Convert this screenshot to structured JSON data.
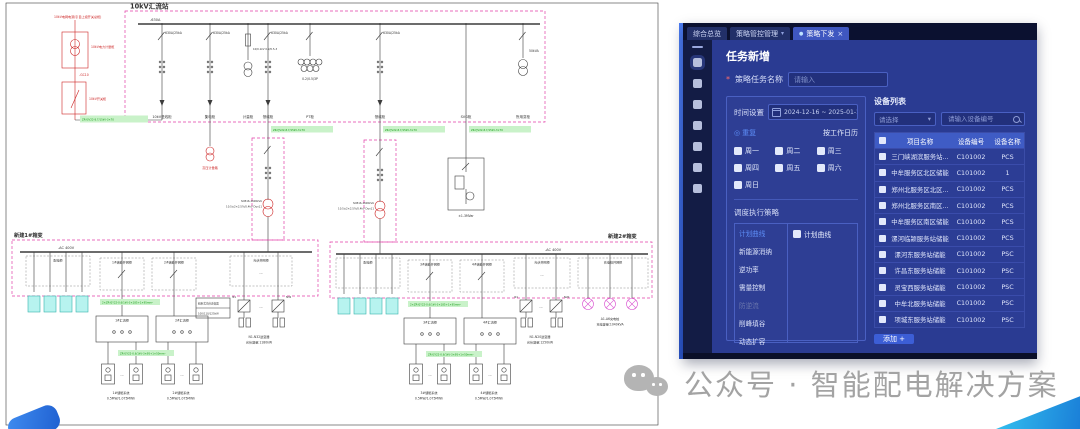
{
  "icons": {
    "caret": "▾",
    "close": "×",
    "dot": "●",
    "radio": "◎",
    "ellipsis": "···"
  },
  "diagram": {
    "station_title": "10kV汇流站",
    "incoming_source": "10kV电网电源(引自上级开关总柜)",
    "incoming_metering": "10kV电力计量柜",
    "incoming_node": "-GC10",
    "incoming_switch": "10kV开关柜",
    "hv_metering_box": "高压计量箱",
    "bus_label": "-630A",
    "bays": [
      {
        "rating": "630A/25kA",
        "name": "10kV进线柜"
      },
      {
        "rating": "630A/25kA",
        "name": "集电柜"
      },
      {
        "rating": "10/0.1kV 0.2/0.5-3",
        "name": "计量柜"
      },
      {
        "rating": "630A/25kA",
        "name": "馈线柜"
      },
      {
        "rating": "0.2/0.5/3P",
        "name": "PT柜"
      },
      {
        "rating": "630A/25kA",
        "name": "馈线柜"
      },
      {
        "rating": "",
        "name": "SVG柜"
      },
      {
        "rating": "50kVA",
        "name": "所用变柜"
      }
    ],
    "hv_cable": "ZR-YJV22-8.7/15kV-3×70",
    "lv_cable_1": "2×ZR-YJY22-0.6/1kV-3×185+1×95mm²",
    "lv_cable_2": "ZR-YJY22-0.6/1kV-3×95+1×50mm²",
    "transformer_spec_1": "SCB16-1600kVA",
    "transformer_spec_2": "10.5±2×2.5%/0.4kV Dyn11",
    "svg_device": "±1-3MVar",
    "box1": {
      "name": "新建1#箱变",
      "lv_bus": "-AC 400V",
      "dist_cabinet": "配电柜",
      "ess_cabinet_1": "1#储能并网柜",
      "ess_cabinet_2": "2#储能并网柜",
      "pv_cabinet": "光伏并网柜",
      "combiner_1": "1#汇流柜",
      "combiner_2": "2#汇流柜",
      "inv_first": "N1",
      "inv_last": "N32",
      "inv_note_1": "组串式光伏逆变器",
      "inv_note_2": "100/110/125kW",
      "pv_label_1": "N1-N32逆变器",
      "pv_label_2": "光伏容量:1180kW",
      "ess_1a": "1#储能系统",
      "ess_1b": "0.5MW/1.075MWh",
      "ess_2a": "2#储能系统",
      "ess_2b": "0.5MW/1.075MWh"
    },
    "box2": {
      "name": "新建2#箱变",
      "lv_bus": "-AC 400V",
      "dist_cabinet": "配电柜",
      "ess_cabinet_1": "3#储能并网柜",
      "ess_cabinet_2": "4#储能并网柜",
      "pv_cabinet": "光伏并网柜",
      "ev_cabinet": "充电桩并网柜",
      "combiner_1": "3#汇流柜",
      "combiner_2": "4#汇流柜",
      "inv_first": "N1",
      "inv_last": "N20",
      "pv_label_1": "N1-N20逆变器",
      "pv_label_2": "光伏容量:1250kW",
      "ev_label_1": "A1-A6充电桩",
      "ev_label_2": "充电容量:1040kVA",
      "ess_1a": "3#储能系统",
      "ess_1b": "0.5MW/1.075MWh",
      "ess_2a": "4#储能系统",
      "ess_2b": "0.5MW/1.075MWh"
    }
  },
  "panel": {
    "tabs": [
      {
        "label": "综合总览"
      },
      {
        "label": "策略管控管理"
      },
      {
        "label": "策略下发"
      }
    ],
    "page_title": "任务新增",
    "form": {
      "required_mark": "*",
      "task_name_label": "策略任务名称",
      "task_name_placeholder": "请输入"
    },
    "schedule": {
      "time_label": "时间设置",
      "date_range": "2024-12-16 ~ 2025-01-18",
      "repeat_label": "重复",
      "work_calendar_label": "按工作日历",
      "weekdays": [
        "周一",
        "周二",
        "周三",
        "周四",
        "周五",
        "周六",
        "周日"
      ],
      "strategy_section_label": "调度执行策略",
      "strategies": [
        {
          "label": "计划曲线"
        },
        {
          "label": "新能源消纳"
        },
        {
          "label": "逆功率"
        },
        {
          "label": "需量控制"
        },
        {
          "label": "防逆流"
        },
        {
          "label": "削峰填谷"
        },
        {
          "label": "动态扩容"
        }
      ],
      "strategy_checkbox_label": "计划曲线"
    },
    "device_list": {
      "title": "设备列表",
      "select_placeholder": "请选择",
      "search_placeholder": "请输入设备编号",
      "columns": [
        "项目名称",
        "设备编号",
        "设备名称"
      ],
      "rows": [
        {
          "project": "三门峡湖滨服务站...",
          "code": "C101002",
          "name": "PCS"
        },
        {
          "project": "中牟服务区北区储能",
          "code": "C101002",
          "name": "1"
        },
        {
          "project": "郑州北服务区北区...",
          "code": "C101002",
          "name": "PCS"
        },
        {
          "project": "郑州北服务区南区...",
          "code": "C101002",
          "name": "PCS"
        },
        {
          "project": "中牟服务区南区储能",
          "code": "C101002",
          "name": "PCS"
        },
        {
          "project": "漯河临颍服务站储能",
          "code": "C101002",
          "name": "PCS"
        },
        {
          "project": "漯河东服务站储能",
          "code": "C101002",
          "name": "PSC"
        },
        {
          "project": "许昌东服务站储能",
          "code": "C101002",
          "name": "PSC"
        },
        {
          "project": "灵宝西服务站储能",
          "code": "C101002",
          "name": "PSC"
        },
        {
          "project": "中牟北服务站储能",
          "code": "C101002",
          "name": "PSC"
        },
        {
          "project": "项城东服务站储能",
          "code": "C101002",
          "name": "PSC"
        }
      ],
      "add_button": "添加 +"
    }
  },
  "watermark": {
    "text": "公众号 · 智能配电解决方案"
  }
}
